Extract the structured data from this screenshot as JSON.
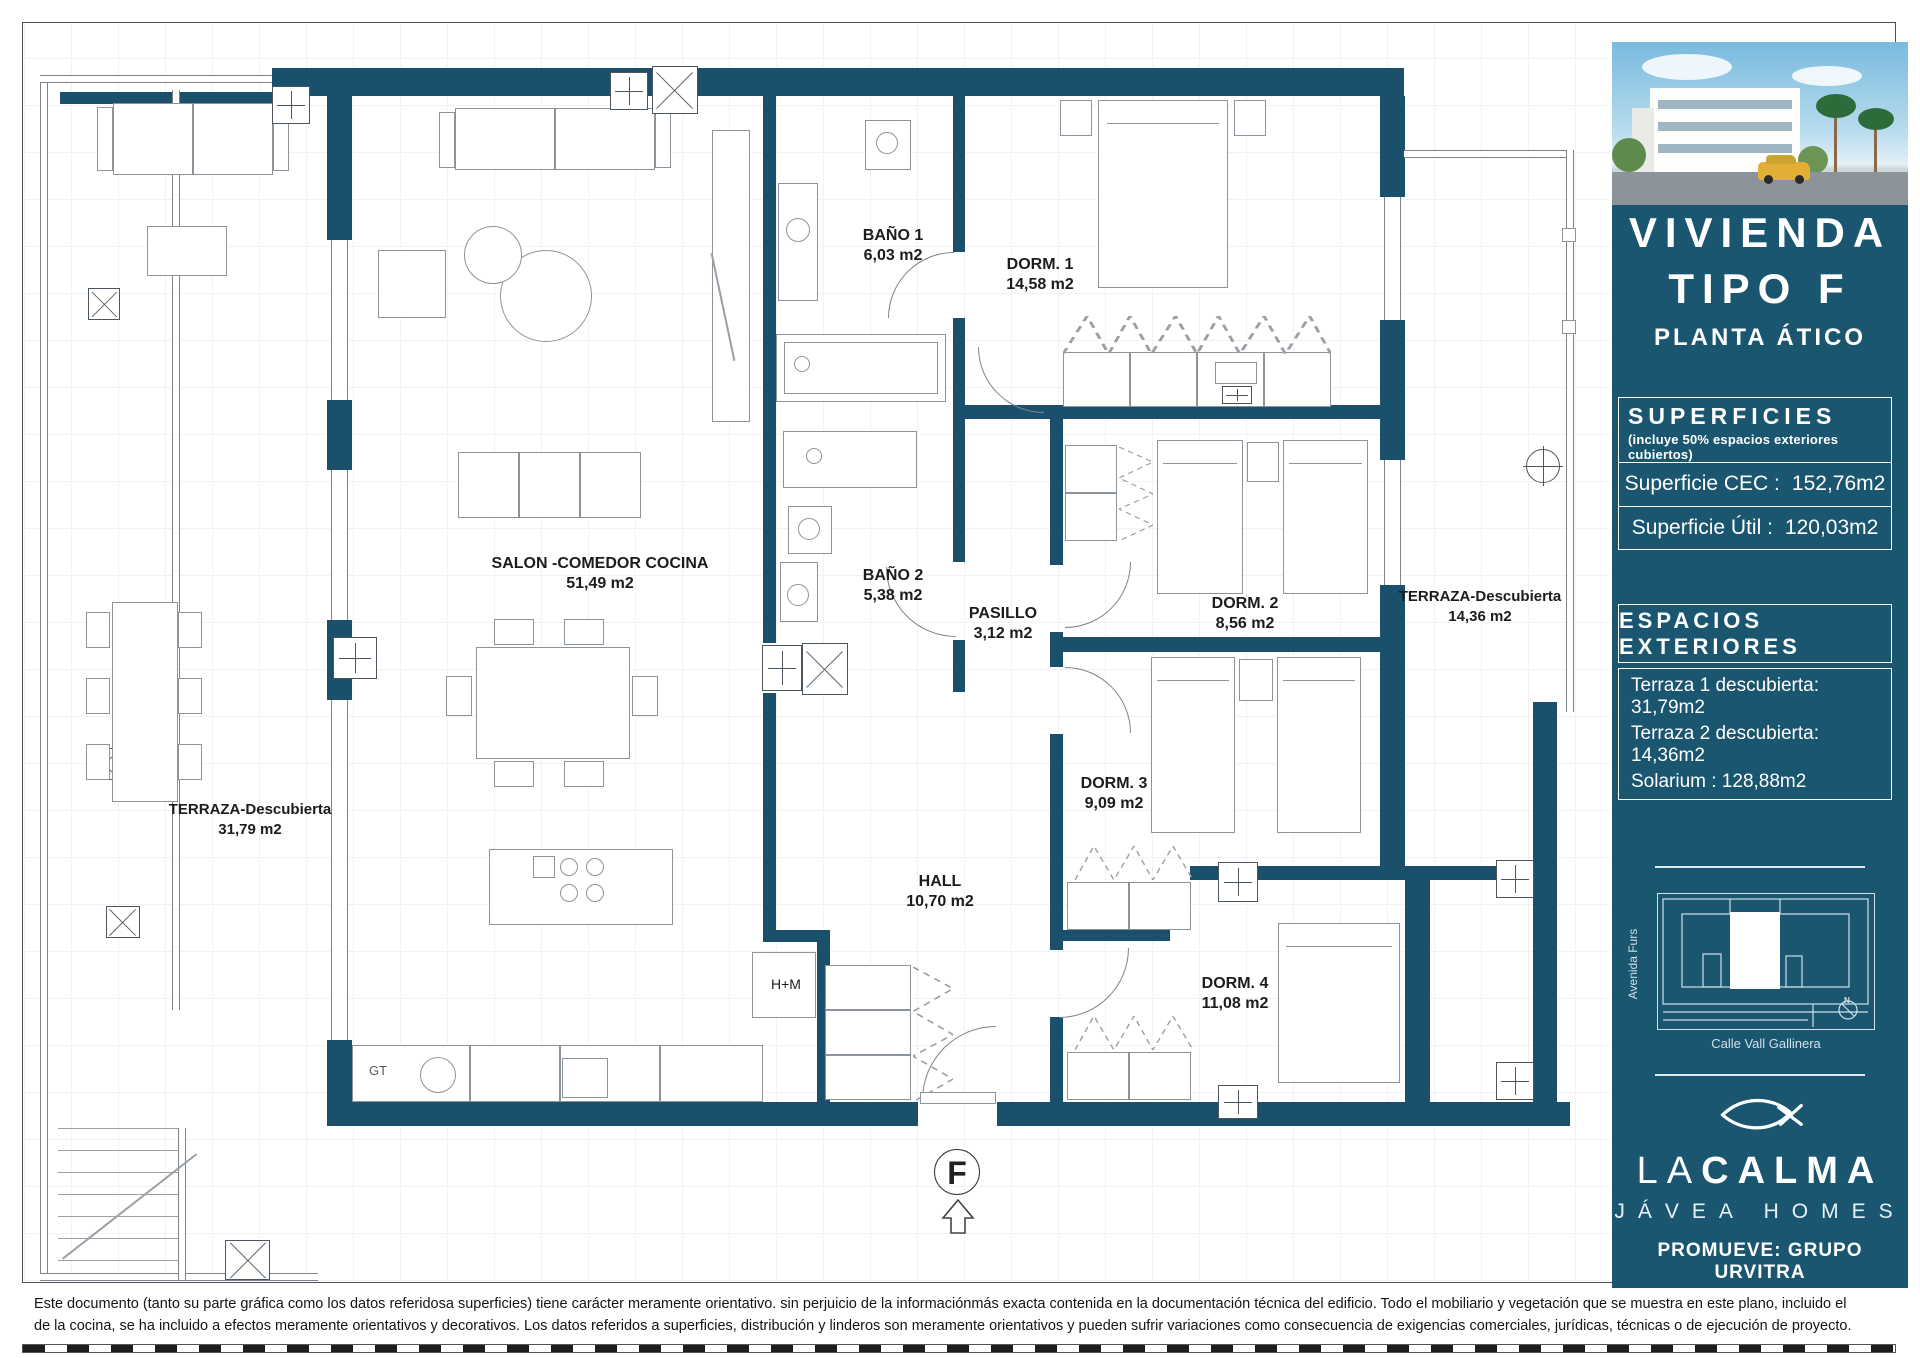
{
  "colors": {
    "wall": "#1a506c",
    "sidebar_bg": "#1a566f",
    "line_gray": "#8d939a",
    "accent_light": "#cfe0ea"
  },
  "plan": {
    "rooms": [
      {
        "name": "SALON -COMEDOR COCINA",
        "area": "51,49 m2"
      },
      {
        "name": "BAÑO 1",
        "area": "6,03 m2"
      },
      {
        "name": "DORM. 1",
        "area": "14,58 m2"
      },
      {
        "name": "BAÑO 2",
        "area": "5,38 m2"
      },
      {
        "name": "PASILLO",
        "area": "3,12 m2"
      },
      {
        "name": "DORM. 2",
        "area": "8,56 m2"
      },
      {
        "name": "DORM. 3",
        "area": "9,09 m2"
      },
      {
        "name": "HALL",
        "area": "10,70 m2"
      },
      {
        "name": "DORM. 4",
        "area": "11,08 m2"
      },
      {
        "name": "TERRAZA-Descubierta",
        "area": "14,36 m2"
      },
      {
        "name": "TERRAZA-Descubierta",
        "area": "31,79 m2"
      }
    ],
    "small": {
      "laundry": "H+M",
      "kitchen_unit": "GT",
      "unit_letter": "F"
    }
  },
  "sidebar": {
    "title1": "VIVIENDA",
    "title2": "TIPO F",
    "subtitle": "PLANTA ÁTICO",
    "superficies": {
      "title": "SUPERFICIES",
      "note": "(incluye 50% espacios exteriores cubiertos)",
      "rows": [
        {
          "label": "Superficie CEC :",
          "value": "152,76m2"
        },
        {
          "label": "Superficie Útil :",
          "value": "120,03m2"
        }
      ]
    },
    "espacios": {
      "title": "ESPACIOS EXTERIORES",
      "items": [
        "Terraza 1 descubierta: 31,79m2",
        "Terraza 2 descubierta: 14,36m2",
        "Solarium : 128,88m2"
      ]
    },
    "map": {
      "street_left": "Avenida Furs",
      "street_bottom": "Calle Vall Gallinera",
      "north": "N"
    },
    "brand": {
      "thin": "LA",
      "bold": "CALMA",
      "tagline": "JÁVEA HOMES",
      "promoter": "PROMUEVE: GRUPO URVITRA"
    }
  },
  "footer": {
    "line1": "Este documento (tanto su parte gráfica como los datos referidosa superficies) tiene carácter meramente orientativo. sin perjuicio de la informaciónmás exacta contenida en la documentación técnica del edificio. Todo el mobiliario y vegetación que se muestra en este plano, incluido el",
    "line2": "de la cocina, se ha incluido a efectos meramente orientativos y decorativos. Los datos referidos a superficies, distribución y linderos son meramente orientativos y pueden sufrir variaciones como consecuencia de exigencias comerciales, jurídicas, técnicas o de ejecución de proyecto."
  }
}
